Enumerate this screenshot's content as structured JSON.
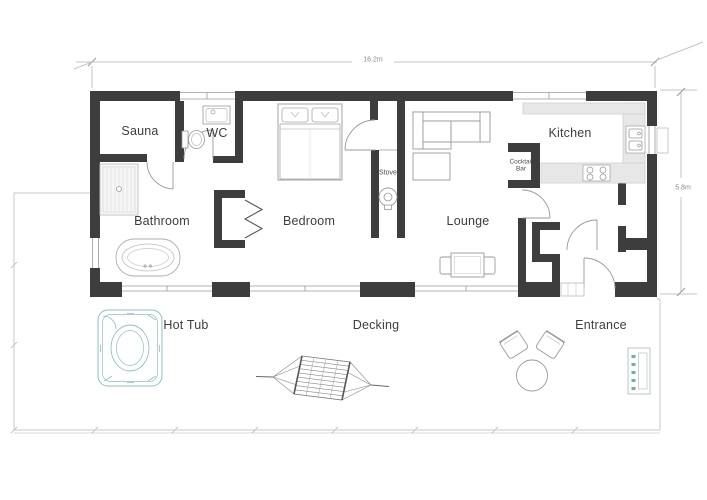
{
  "plan": {
    "dimensions": {
      "width": "16.2m",
      "height": "5.8m"
    },
    "rooms": [
      {
        "id": "sauna",
        "label": "Sauna"
      },
      {
        "id": "wc",
        "label": "WC"
      },
      {
        "id": "bathroom",
        "label": "Bathroom"
      },
      {
        "id": "bedroom",
        "label": "Bedroom"
      },
      {
        "id": "lounge",
        "label": "Lounge"
      },
      {
        "id": "kitchen",
        "label": "Kitchen"
      }
    ],
    "fixtures": [
      {
        "id": "stove",
        "label": "Stove"
      },
      {
        "id": "cocktail-bar",
        "label": "Cocktail Bar"
      }
    ],
    "outdoor": [
      {
        "id": "hot-tub",
        "label": "Hot Tub"
      },
      {
        "id": "decking",
        "label": "Decking"
      },
      {
        "id": "entrance",
        "label": "Entrance"
      }
    ],
    "colors": {
      "wall": "#3d3d3d",
      "counter": "#e7e7e7",
      "accent": "#8fbfc6",
      "label": "#3d3d3d",
      "dimension": "#8a8a8a"
    }
  }
}
